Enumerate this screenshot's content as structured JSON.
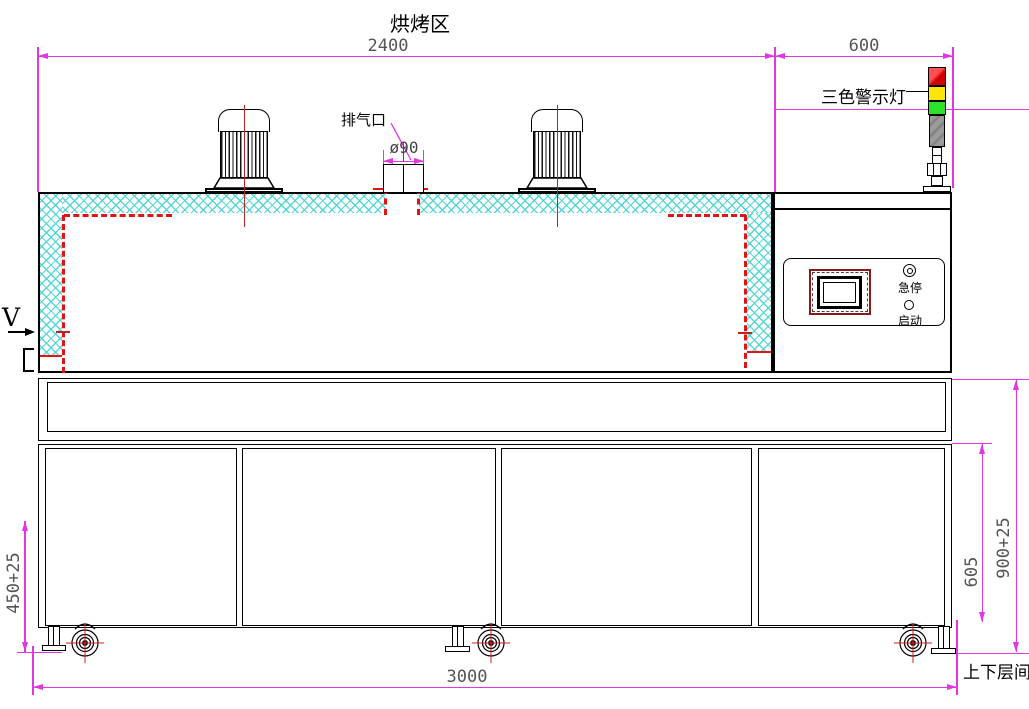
{
  "drawing": {
    "zone_label": "烘烤区",
    "warning_light_label": "三色警示灯",
    "exhaust_label": "排气口",
    "exhaust_diameter": "ø90",
    "direction_label": "V",
    "layers_label": "上下层间",
    "control_panel": {
      "emergency_stop_label": "急停",
      "start_label": "启动"
    },
    "dimensions": {
      "baking_zone_length": "2400",
      "control_section_length": "600",
      "total_length": "3000",
      "lower_layer_height": "450+25",
      "door_height": "605",
      "table_height": "900+25"
    },
    "colors": {
      "dimension_line": "#e335e3",
      "insulation_hatch": "#46d2d2",
      "chamber_dashed": "#e01414",
      "light_red": "#e81515",
      "light_yellow": "#ffe60a",
      "light_green": "#2ce02c",
      "light_body_gray": "#949494"
    }
  }
}
